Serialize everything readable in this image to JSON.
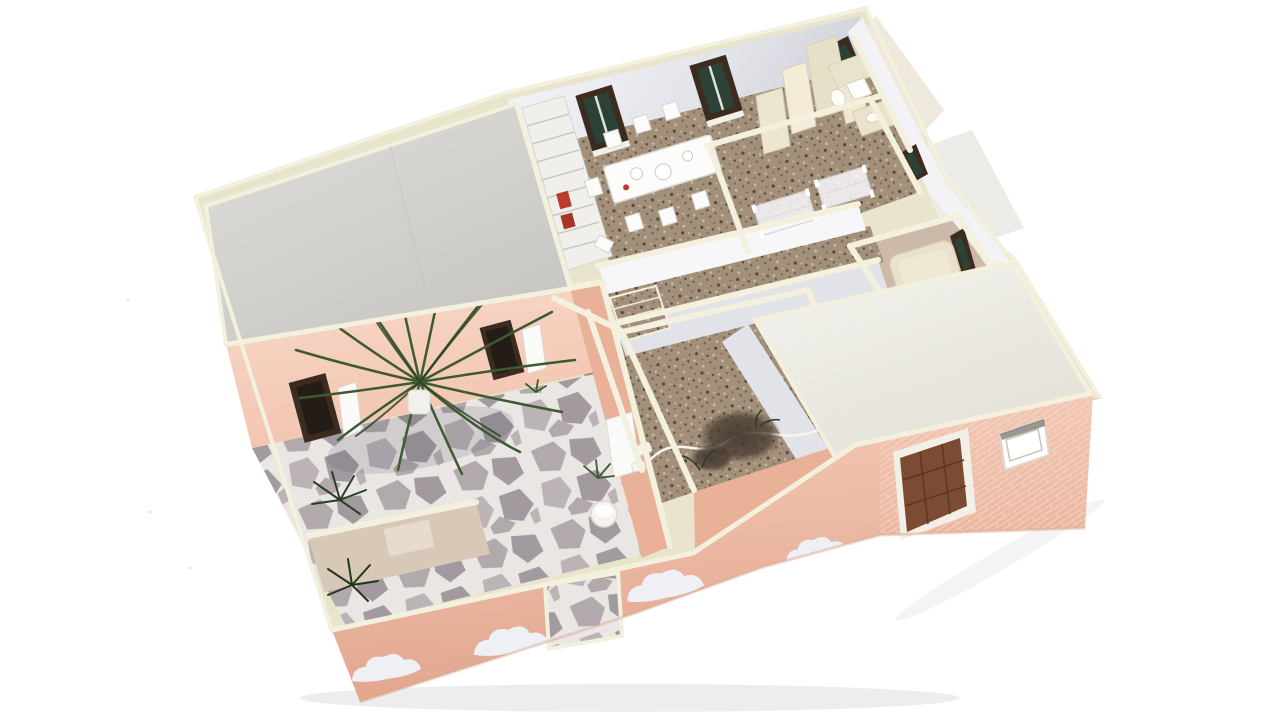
{
  "scene": {
    "subject": "Photograph of a miniature cardboard architectural model of a single-storey house, viewed from above at an angle on a white background, with lift-off grey and white roof panels, an open courtyard with flagstone paving and palm plants, pink exterior walls decorated with white clouds, a brown front door and furnished miniature rooms",
    "rooms": [
      {
        "id": "dining-room",
        "label": "Dining room with table and chairs"
      },
      {
        "id": "kitchen",
        "label": "Kitchenette with tall cabinets"
      },
      {
        "id": "rear-bathroom",
        "label": "Rear bathroom with fixtures"
      },
      {
        "id": "bedroom",
        "label": "Bedroom with twin beds"
      },
      {
        "id": "side-room",
        "label": "Side room"
      },
      {
        "id": "bathtub-bathroom",
        "label": "Bathroom with bathtub"
      },
      {
        "id": "hallway",
        "label": "Hallway with speckled carpet"
      },
      {
        "id": "utility-room",
        "label": "Utility room with cable and debris"
      },
      {
        "id": "courtyard",
        "label": "Courtyard with flagstone floor and plants"
      },
      {
        "id": "covered-room",
        "label": "Room covered by white roof panel"
      }
    ],
    "objects": [
      {
        "id": "left-roof",
        "label": "Grey removable roof panel"
      },
      {
        "id": "right-roof",
        "label": "White removable roof panel"
      },
      {
        "id": "staircase",
        "label": "Staircase"
      },
      {
        "id": "corridor-steps",
        "label": "Small corridor steps"
      },
      {
        "id": "dining-table",
        "label": "Dining table with dishes"
      },
      {
        "id": "palm-plant",
        "label": "Palm plant in white pot"
      },
      {
        "id": "shrubs",
        "label": "Dark green shrubs"
      },
      {
        "id": "front-door",
        "label": "Brown panelled front door"
      },
      {
        "id": "facade-window",
        "label": "Open window in cloud facade"
      },
      {
        "id": "cloud-mural",
        "label": "White cloud mural on pink facade"
      },
      {
        "id": "bathtub",
        "label": "Beige bathtub"
      },
      {
        "id": "bucket",
        "label": "White round planter"
      }
    ]
  },
  "colors": {
    "bg": "#ffffff",
    "cream": "#e9e5cd",
    "creamLight": "#f3f0dd",
    "creamShade": "#d8d2b4",
    "roofGrayA": "#dfdeda",
    "roofGrayB": "#c7c6c2",
    "roofWhiteA": "#f4f3ee",
    "roofWhiteB": "#e3e1d7",
    "wallWhite": "#f7f7fa",
    "wallShade": "#e2e3e9",
    "wallDark": "#cfd1d9",
    "floorBrown": "#a3907b",
    "speckDark": "#75634d",
    "speckDarker": "#57493a",
    "speckLight": "#cabba3",
    "flagBase": "#eae6e4",
    "stoneA": "#b1a9ac",
    "stoneB": "#a29a9e",
    "stoneC": "#bbb3b6",
    "pink": "#f2c5b0",
    "pinkLight": "#f8d8c8",
    "pinkDark": "#e9b198",
    "pinkExt": "#f5cdbb",
    "pinkDeep": "#e2a68e",
    "brickLine": "#f9ddd2",
    "frame": "#3c2c20",
    "glass": "#2d4236",
    "door": "#7b4b33",
    "doorDark": "#5d3526",
    "beige": "#e9e2cc",
    "beigeDark": "#d6cdb0",
    "tan": "#cdb9a9",
    "tanWall": "#d8c8b8",
    "white": "#ffffff",
    "green": "#3d5a31",
    "greenDark": "#293f23",
    "greenLight": "#5f7d4a",
    "fuzz": "#473a30",
    "red": "#bb3a2e",
    "cloud": "#eef0f5",
    "shadow": "#e9e9ea"
  }
}
